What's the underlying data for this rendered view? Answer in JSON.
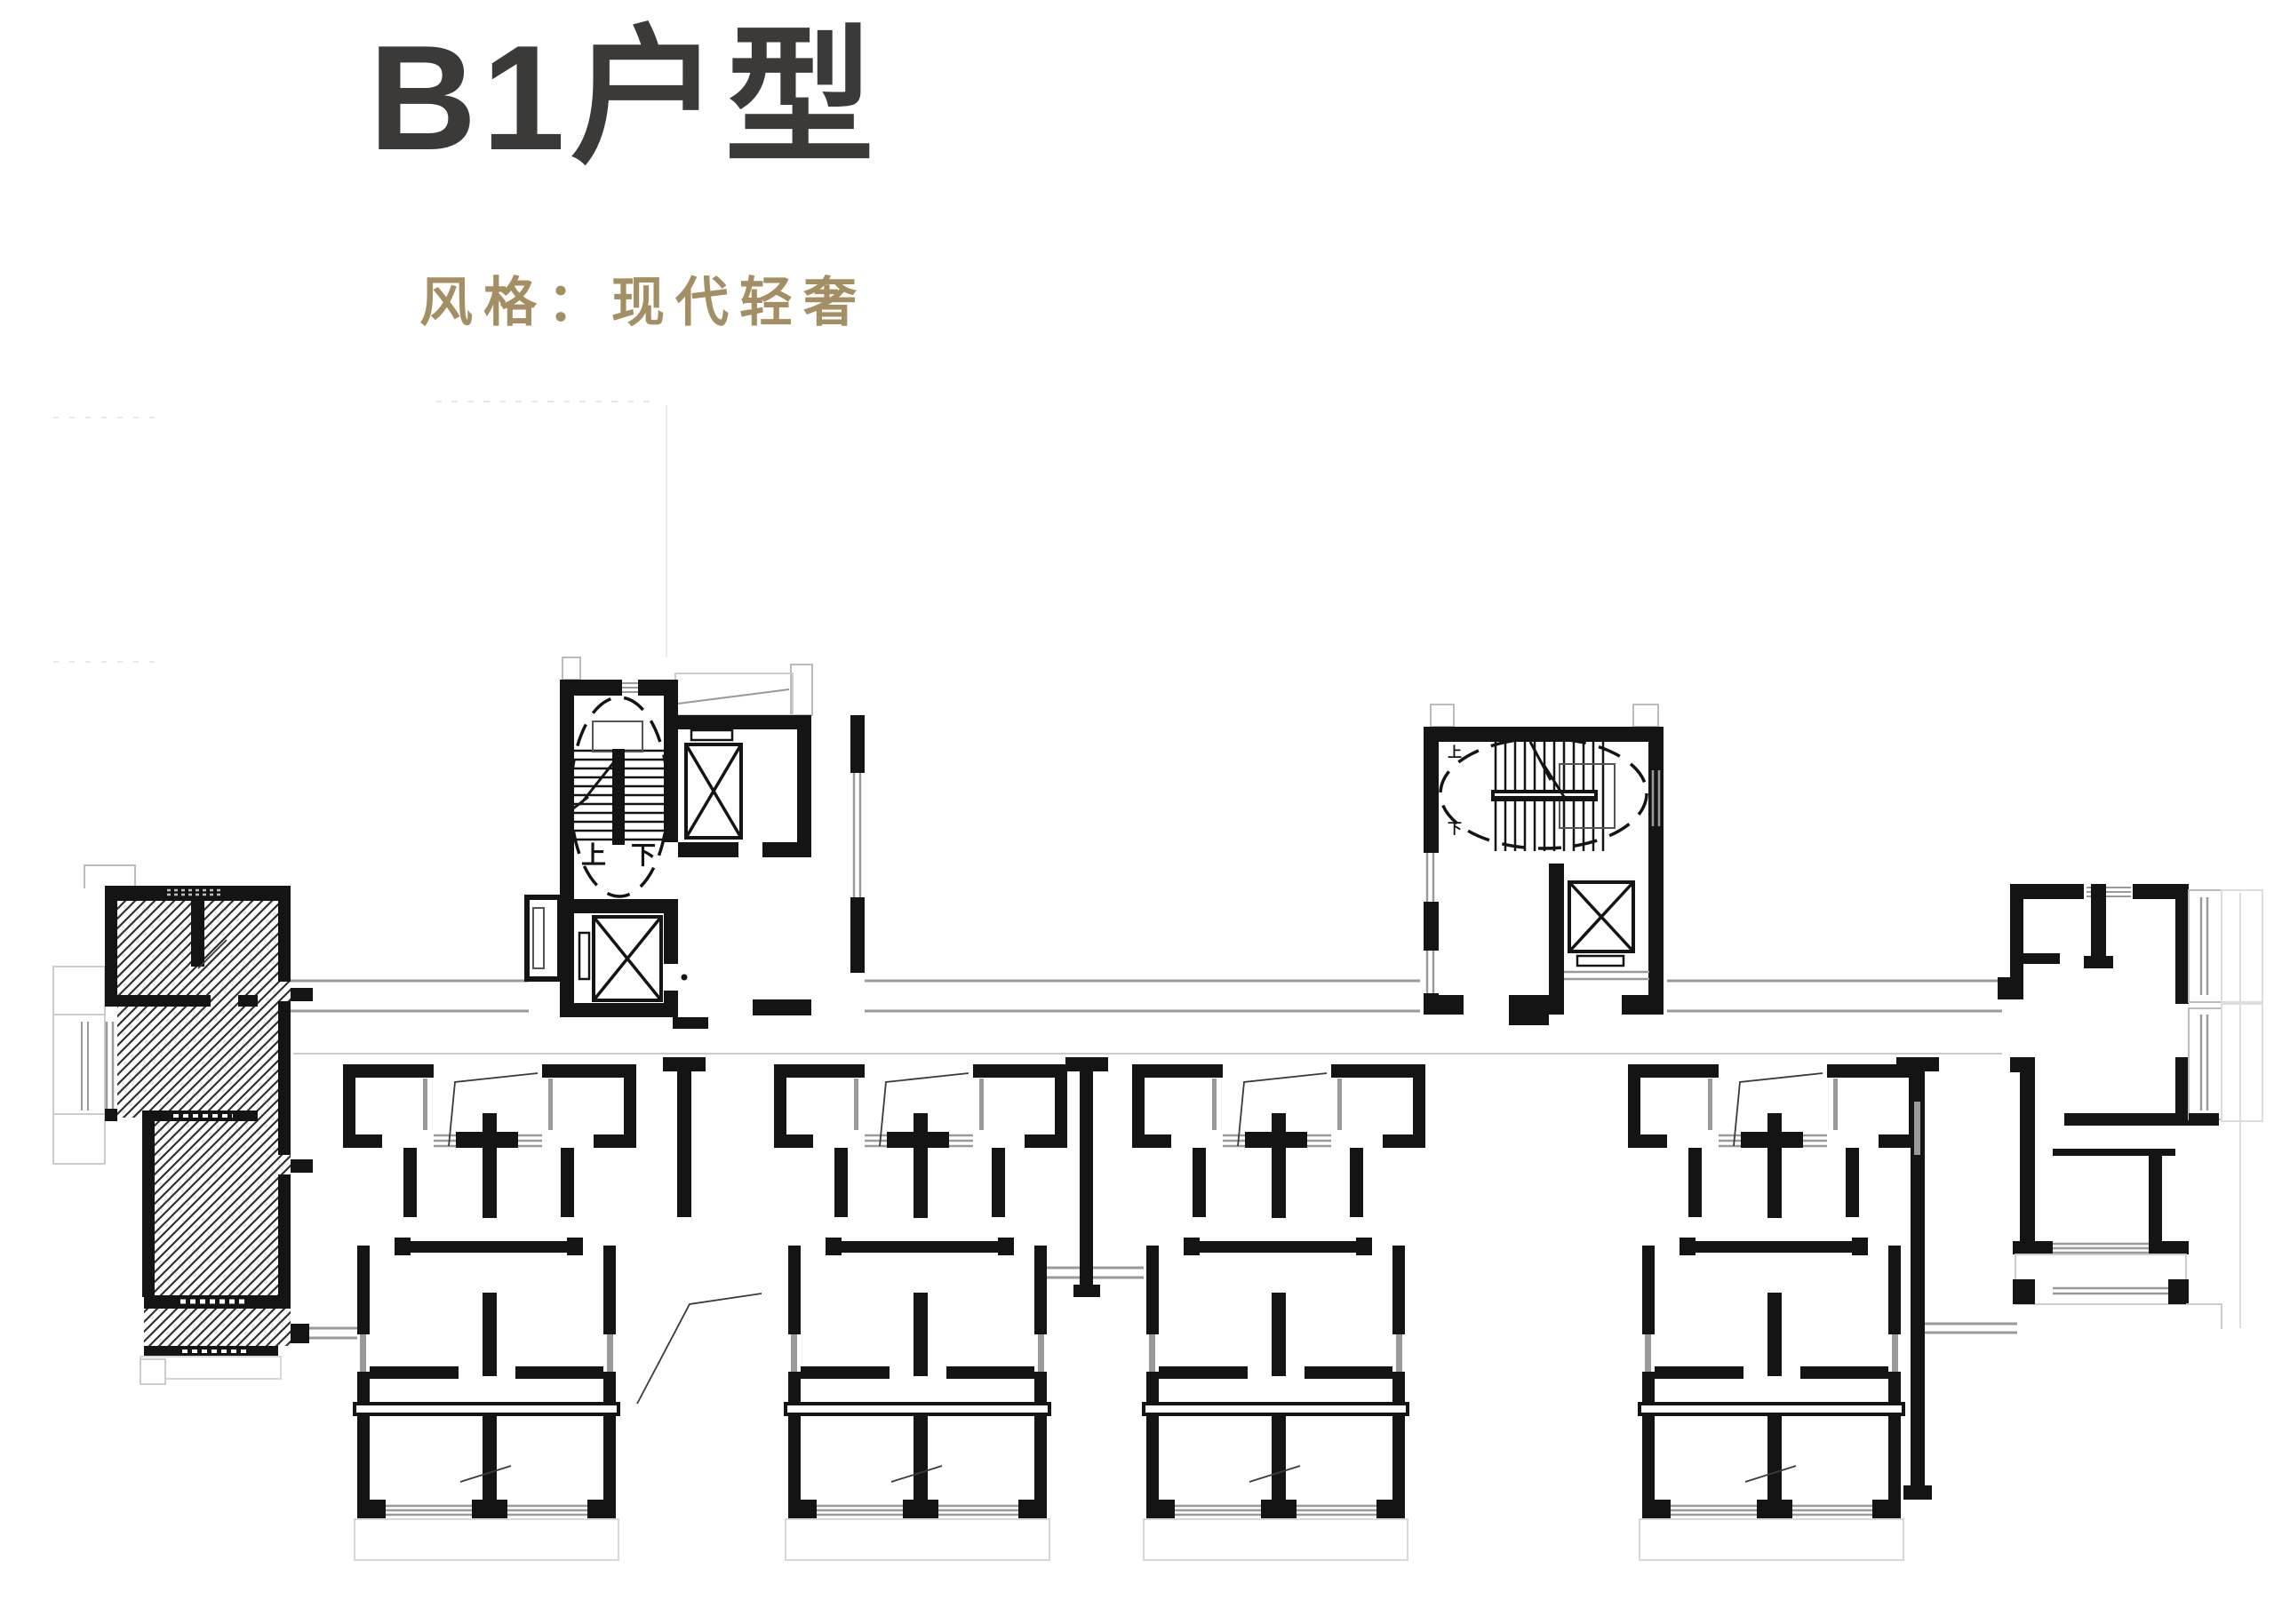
{
  "header": {
    "title": "B1户型",
    "subtitle": "风格：现代轻奢"
  },
  "floor_plan": {
    "stair_labels": {
      "left_up": "上",
      "left_down": "下",
      "right_up": "上",
      "right_down": "下"
    },
    "colors": {
      "background": "#ffffff",
      "wall": "#141414",
      "hatch_line": "#303030",
      "thin_line": "#9a9a9a",
      "faint_line": "#cccccc",
      "title_text": "#3b3a39",
      "subtitle_text": "#a48e63"
    }
  }
}
